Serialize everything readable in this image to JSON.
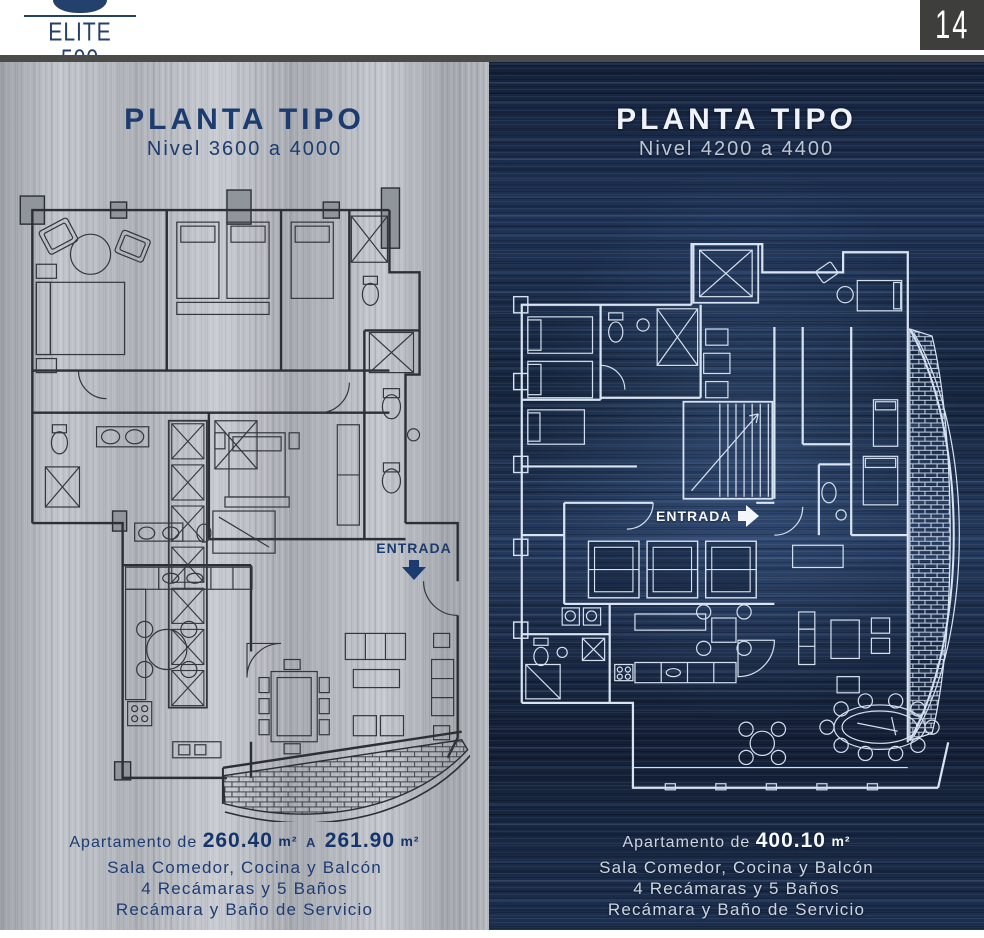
{
  "header": {
    "brand": {
      "name": "ELITE 500",
      "tagline": "DOS MARES"
    },
    "page_number": "14"
  },
  "panels": {
    "left": {
      "title": "PLANTA TIPO",
      "subtitle": "Nivel 3600 a 4000",
      "entrance_label": "ENTRADA",
      "area": {
        "prefix": "Apartamento de",
        "value1": "260.40",
        "unit1": "m²",
        "connector": "A",
        "value2": "261.90",
        "unit2": "m²"
      },
      "features": [
        "Sala Comedor, Cocina y Balcón",
        "4 Recámaras y 5 Baños",
        "Recámara y Baño de Servicio"
      ]
    },
    "right": {
      "title": "PLANTA TIPO",
      "subtitle": "Nivel 4200 a 4400",
      "entrance_label": "ENTRADA",
      "area": {
        "prefix": "Apartamento de",
        "value1": "400.10",
        "unit1": "m²",
        "connector": "",
        "value2": "",
        "unit2": ""
      },
      "features": [
        "Sala Comedor, Cocina y Balcón",
        "4 Recámaras y 5 Baños",
        "Recámara y Baño de Servicio"
      ]
    }
  },
  "colors": {
    "navy_text": "#1c3b6f",
    "light_text": "#f0f4fa",
    "silver_base": "#b7bbc1",
    "navy_base": "#1b2b49",
    "charcoal_band": "#4b4b49"
  }
}
